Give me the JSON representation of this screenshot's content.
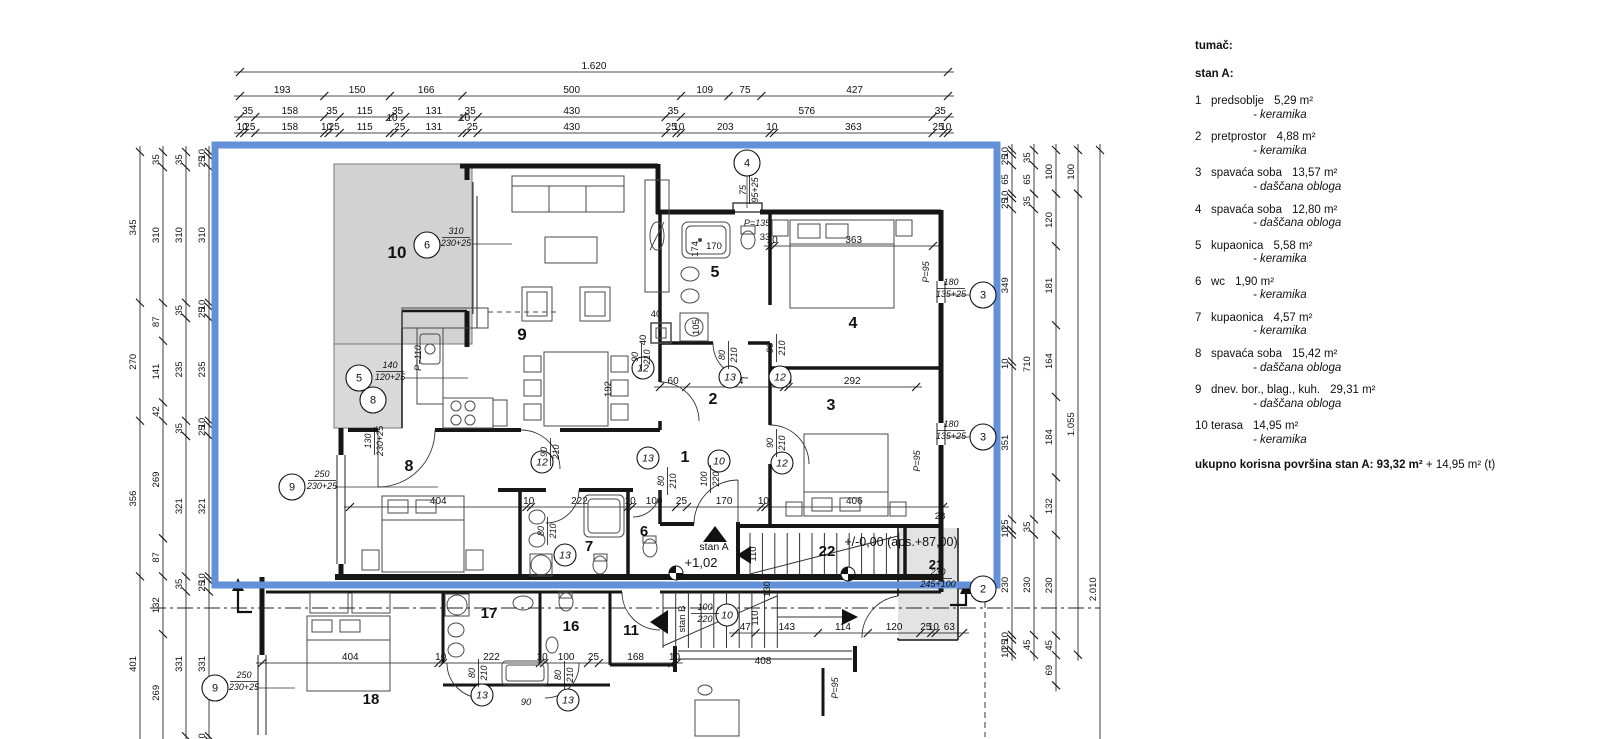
{
  "legend": {
    "title": "tumač:",
    "apartment": "stan A:",
    "items": [
      {
        "num": "1",
        "name": "predsoblje",
        "area": "5,29 m²",
        "finish": "- keramika"
      },
      {
        "num": "2",
        "name": "pretprostor",
        "area": "4,88 m²",
        "finish": "- keramika"
      },
      {
        "num": "3",
        "name": "spavaća soba",
        "area": "13,57 m²",
        "finish": "- daščana obloga"
      },
      {
        "num": "4",
        "name": "spavaća soba",
        "area": "12,80 m²",
        "finish": "- daščana obloga"
      },
      {
        "num": "5",
        "name": "kupaonica",
        "area": "5,58 m²",
        "finish": "- keramika"
      },
      {
        "num": "6",
        "name": "wc",
        "area": "1,90 m²",
        "finish": "- keramika"
      },
      {
        "num": "7",
        "name": "kupaonica",
        "area": "4,57 m²",
        "finish": "- keramika"
      },
      {
        "num": "8",
        "name": "spavaća soba",
        "area": "15,42 m²",
        "finish": "- daščana obloga"
      },
      {
        "num": "9",
        "name": "dnev. bor., blag., kuh.",
        "area": "29,31 m²",
        "finish": "- daščana obloga"
      },
      {
        "num": "10",
        "name": "terasa",
        "area": "14,95 m²",
        "finish": "- keramika"
      }
    ],
    "total_bold": "ukupno korisna površina stan A: 93,32 m²",
    "total_rest": " + 14,95 m² (t)"
  },
  "plan": {
    "colors": {
      "boundary": "#6290d9",
      "terrace_fill": "#d2d2d2",
      "terrace_fill2": "#d9d9d9",
      "room21_fill": "#e3e3e3",
      "wall": "#161616",
      "dim": "#111111"
    },
    "scale_px_per_unit": 0.437,
    "chains": [
      {
        "o": "h",
        "line": 72,
        "start": 240,
        "vals": [
          1620
        ]
      },
      {
        "o": "h",
        "line": 96,
        "start": 240,
        "vals": [
          193,
          150,
          166,
          500,
          109,
          75,
          427
        ]
      },
      {
        "o": "h",
        "line": 117,
        "start": 240,
        "vals": [
          35,
          158,
          35,
          115,
          35,
          131,
          35,
          430,
          35,
          576,
          35
        ]
      },
      {
        "o": "h",
        "line": 133,
        "start": 240,
        "vals": [
          10,
          25,
          158,
          10,
          25,
          115,
          {
            "v": 10,
            "dy": -9
          },
          25,
          131,
          {
            "v": 10,
            "dy": -9
          },
          25,
          430,
          25,
          10,
          203,
          10,
          363,
          25,
          10
        ]
      },
      {
        "o": "v",
        "line": 140,
        "start": 152,
        "vals": [
          345,
          270,
          356,
          401
        ]
      },
      {
        "o": "v",
        "line": 163,
        "start": 152,
        "vals": [
          35,
          310,
          87,
          141,
          42,
          269,
          87,
          132,
          269
        ]
      },
      {
        "o": "v",
        "line": 186,
        "start": 152,
        "vals": [
          35,
          310,
          35,
          235,
          35,
          321,
          35,
          331,
          35
        ]
      },
      {
        "o": "v",
        "line": 209,
        "start": 152,
        "vals": [
          10,
          25,
          310,
          10,
          25,
          235,
          10,
          25,
          321,
          10,
          25,
          331,
          10,
          25
        ]
      },
      {
        "o": "v",
        "line": 1012,
        "start": 150,
        "vals": [
          10,
          25,
          65,
          10,
          25,
          349,
          10,
          351,
          25,
          10,
          230,
          10,
          25,
          10
        ]
      },
      {
        "o": "v",
        "line": 1034,
        "start": 150,
        "vals": [
          35,
          65,
          35,
          710,
          35,
          230,
          45
        ]
      },
      {
        "o": "v",
        "line": 1056,
        "start": 150,
        "vals": [
          100,
          120,
          181,
          164,
          184,
          132,
          230,
          45,
          69
        ]
      },
      {
        "o": "v",
        "line": 1078,
        "start": 150,
        "vals": [
          100,
          1055
        ]
      },
      {
        "o": "v",
        "line": 1100,
        "start": 150,
        "vals": [
          2010
        ]
      },
      {
        "o": "h",
        "line": 507,
        "start": 350,
        "vals": [
          404,
          10,
          222,
          10,
          100,
          25,
          170,
          10,
          406
        ]
      },
      {
        "o": "h",
        "line": 663,
        "start": 262,
        "vals": [
          404,
          10,
          222,
          10,
          100,
          25,
          168,
          10
        ]
      },
      {
        "o": "h",
        "line": 246,
        "start": 770,
        "vals": [
          10,
          363
        ]
      },
      {
        "o": "h",
        "line": 387,
        "start": 660,
        "vals": [
          60,
          224,
          10,
          292
        ]
      },
      {
        "o": "h",
        "line": 633,
        "start": 735,
        "vals": [
          47,
          143,
          114,
          120,
          25,
          10,
          63
        ]
      }
    ],
    "labels": [
      {
        "t": "174",
        "x": 698,
        "y": 249,
        "r": 1,
        "s": 9.5
      },
      {
        "t": "170",
        "x": 714,
        "y": 249,
        "s": 9.5
      },
      {
        "t": "P=135",
        "x": 757,
        "y": 226,
        "i": 1,
        "s": 9
      },
      {
        "t": "33",
        "x": 765,
        "y": 240,
        "s": 9.5
      },
      {
        "t": "P=95",
        "x": 929,
        "y": 272,
        "r": 1,
        "i": 1,
        "s": 9
      },
      {
        "t": "P=95",
        "x": 920,
        "y": 461,
        "r": 1,
        "i": 1,
        "s": 9
      },
      {
        "t": "P=95",
        "x": 838,
        "y": 688,
        "r": 1,
        "i": 1,
        "s": 9
      },
      {
        "t": "P=110",
        "x": 421,
        "y": 358,
        "r": 1,
        "i": 1,
        "s": 9
      },
      {
        "t": "40",
        "x": 656,
        "y": 317,
        "s": 9.5
      },
      {
        "t": "40",
        "x": 646,
        "y": 340,
        "r": 1,
        "s": 9.5
      },
      {
        "t": "105",
        "x": 699,
        "y": 327,
        "r": 1,
        "s": 9.5
      },
      {
        "t": "192",
        "x": 611,
        "y": 389,
        "r": 1,
        "s": 9.5
      },
      {
        "t": "28",
        "x": 940,
        "y": 519,
        "s": 9.5
      },
      {
        "t": "110",
        "x": 756,
        "y": 554,
        "r": 1,
        "s": 9.5
      },
      {
        "t": "130",
        "x": 770,
        "y": 589,
        "r": 1,
        "s": 9.5
      },
      {
        "t": "110",
        "x": 758,
        "y": 618,
        "r": 1,
        "s": 9.5
      },
      {
        "t": "408",
        "x": 763,
        "y": 664,
        "s": 10
      },
      {
        "t": "90",
        "x": 526,
        "y": 705,
        "i": 1,
        "s": 9.5
      },
      {
        "t": "stan A",
        "x": 714,
        "y": 550,
        "s": 10.5
      },
      {
        "t": "+1,02",
        "x": 701,
        "y": 567,
        "s": 13
      },
      {
        "t": "+/-0,00 (aps.+87,00)",
        "x": 901,
        "y": 546,
        "s": 12.5
      },
      {
        "t": "stan B",
        "x": 685,
        "y": 619,
        "r": 1,
        "s": 9.5
      },
      {
        "t": "10",
        "x": 397,
        "y": 258,
        "b": 1,
        "s": 17
      },
      {
        "t": "9",
        "x": 522,
        "y": 340,
        "b": 1,
        "s": 17
      },
      {
        "t": "5",
        "x": 715,
        "y": 277,
        "b": 1,
        "s": 16
      },
      {
        "t": "4",
        "x": 853,
        "y": 328,
        "b": 1,
        "s": 16
      },
      {
        "t": "2",
        "x": 713,
        "y": 404,
        "b": 1,
        "s": 16
      },
      {
        "t": "3",
        "x": 831,
        "y": 410,
        "b": 1,
        "s": 16
      },
      {
        "t": "1",
        "x": 685,
        "y": 462,
        "b": 1,
        "s": 16
      },
      {
        "t": "8",
        "x": 409,
        "y": 471,
        "b": 1,
        "s": 16
      },
      {
        "t": "7",
        "x": 589,
        "y": 551,
        "b": 1,
        "s": 15
      },
      {
        "t": "6",
        "x": 644,
        "y": 536,
        "b": 1,
        "s": 15
      },
      {
        "t": "22",
        "x": 827,
        "y": 556,
        "b": 1,
        "s": 15
      },
      {
        "t": "21",
        "x": 936,
        "y": 569,
        "b": 1,
        "s": 13
      },
      {
        "t": "17",
        "x": 489,
        "y": 618,
        "b": 1,
        "s": 15
      },
      {
        "t": "16",
        "x": 571,
        "y": 631,
        "b": 1,
        "s": 15
      },
      {
        "t": "11",
        "x": 631,
        "y": 635,
        "b": 1,
        "s": 15
      },
      {
        "t": "18",
        "x": 371,
        "y": 704,
        "b": 1,
        "s": 15
      }
    ],
    "markers": [
      {
        "n": "6",
        "x": 427,
        "y": 245
      },
      {
        "n": "5",
        "x": 359,
        "y": 378
      },
      {
        "n": "8",
        "x": 373,
        "y": 400
      },
      {
        "n": "9",
        "x": 292,
        "y": 487
      },
      {
        "n": "9",
        "x": 215,
        "y": 688
      },
      {
        "n": "4",
        "x": 747,
        "y": 163
      },
      {
        "n": "3",
        "x": 983,
        "y": 295
      },
      {
        "n": "3",
        "x": 983,
        "y": 437
      },
      {
        "n": "2",
        "x": 983,
        "y": 589
      },
      {
        "n": "12",
        "x": 643,
        "y": 368,
        "d": 1
      },
      {
        "n": "12",
        "x": 780,
        "y": 377,
        "d": 1
      },
      {
        "n": "12",
        "x": 782,
        "y": 463,
        "d": 1
      },
      {
        "n": "12",
        "x": 542,
        "y": 462,
        "d": 1
      },
      {
        "n": "13",
        "x": 730,
        "y": 377,
        "d": 1
      },
      {
        "n": "13",
        "x": 648,
        "y": 458,
        "d": 1
      },
      {
        "n": "13",
        "x": 565,
        "y": 555,
        "d": 1
      },
      {
        "n": "13",
        "x": 482,
        "y": 695,
        "d": 1
      },
      {
        "n": "13",
        "x": 568,
        "y": 700,
        "d": 1
      },
      {
        "n": "10",
        "x": 719,
        "y": 461,
        "d": 1
      },
      {
        "n": "10",
        "x": 727,
        "y": 615,
        "d": 1
      }
    ],
    "fractions": [
      {
        "n": "310",
        "d": "230+25",
        "x": 456,
        "y": 236
      },
      {
        "n": "140",
        "d": "120+25",
        "x": 390,
        "y": 370
      },
      {
        "n": "250",
        "d": "230+25",
        "x": 322,
        "y": 479
      },
      {
        "n": "250",
        "d": "230+25",
        "x": 244,
        "y": 680
      },
      {
        "n": "230",
        "d": "245+100",
        "x": 938,
        "y": 577
      },
      {
        "n": "180",
        "d": "135+25",
        "x": 951,
        "y": 287
      },
      {
        "n": "180",
        "d": "135+25",
        "x": 951,
        "y": 429
      },
      {
        "n": "75",
        "d": "95+25",
        "x": 748,
        "y": 190,
        "r": 1
      },
      {
        "n": "130",
        "d": "230+25",
        "x": 373,
        "y": 441,
        "r": 1
      },
      {
        "n": "90",
        "d": "210",
        "x": 549,
        "y": 452,
        "r": 1
      },
      {
        "n": "90",
        "d": "210",
        "x": 640,
        "y": 357,
        "r": 1
      },
      {
        "n": "80",
        "d": "210",
        "x": 727,
        "y": 355,
        "r": 1
      },
      {
        "n": "90",
        "d": "210",
        "x": 775,
        "y": 348,
        "r": 1
      },
      {
        "n": "90",
        "d": "210",
        "x": 775,
        "y": 443,
        "r": 1
      },
      {
        "n": "80",
        "d": "210",
        "x": 666,
        "y": 481,
        "r": 1
      },
      {
        "n": "100",
        "d": "220",
        "x": 709,
        "y": 479,
        "r": 1
      },
      {
        "n": "80",
        "d": "210",
        "x": 546,
        "y": 531,
        "r": 1
      },
      {
        "n": "100",
        "d": "220",
        "x": 705,
        "y": 612
      },
      {
        "n": "80",
        "d": "210",
        "x": 477,
        "y": 673,
        "r": 1
      },
      {
        "n": "80",
        "d": "210",
        "x": 563,
        "y": 675,
        "r": 1
      }
    ]
  }
}
